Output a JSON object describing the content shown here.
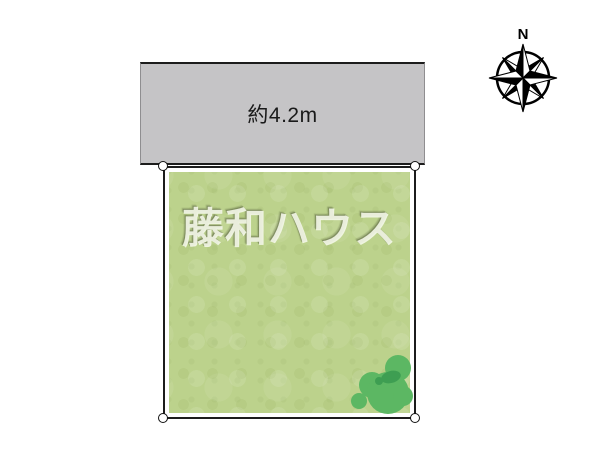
{
  "road": {
    "width_label": "約4.2m",
    "fill": "#c5c4c6"
  },
  "plot": {
    "watermark": "藤和ハウス",
    "fill": "#bcd28c",
    "border_color": "#1c1c1c"
  },
  "trees": {
    "fill": "#5cb763",
    "dark_fill": "#3e9e52"
  },
  "compass": {
    "north_label": "N"
  }
}
